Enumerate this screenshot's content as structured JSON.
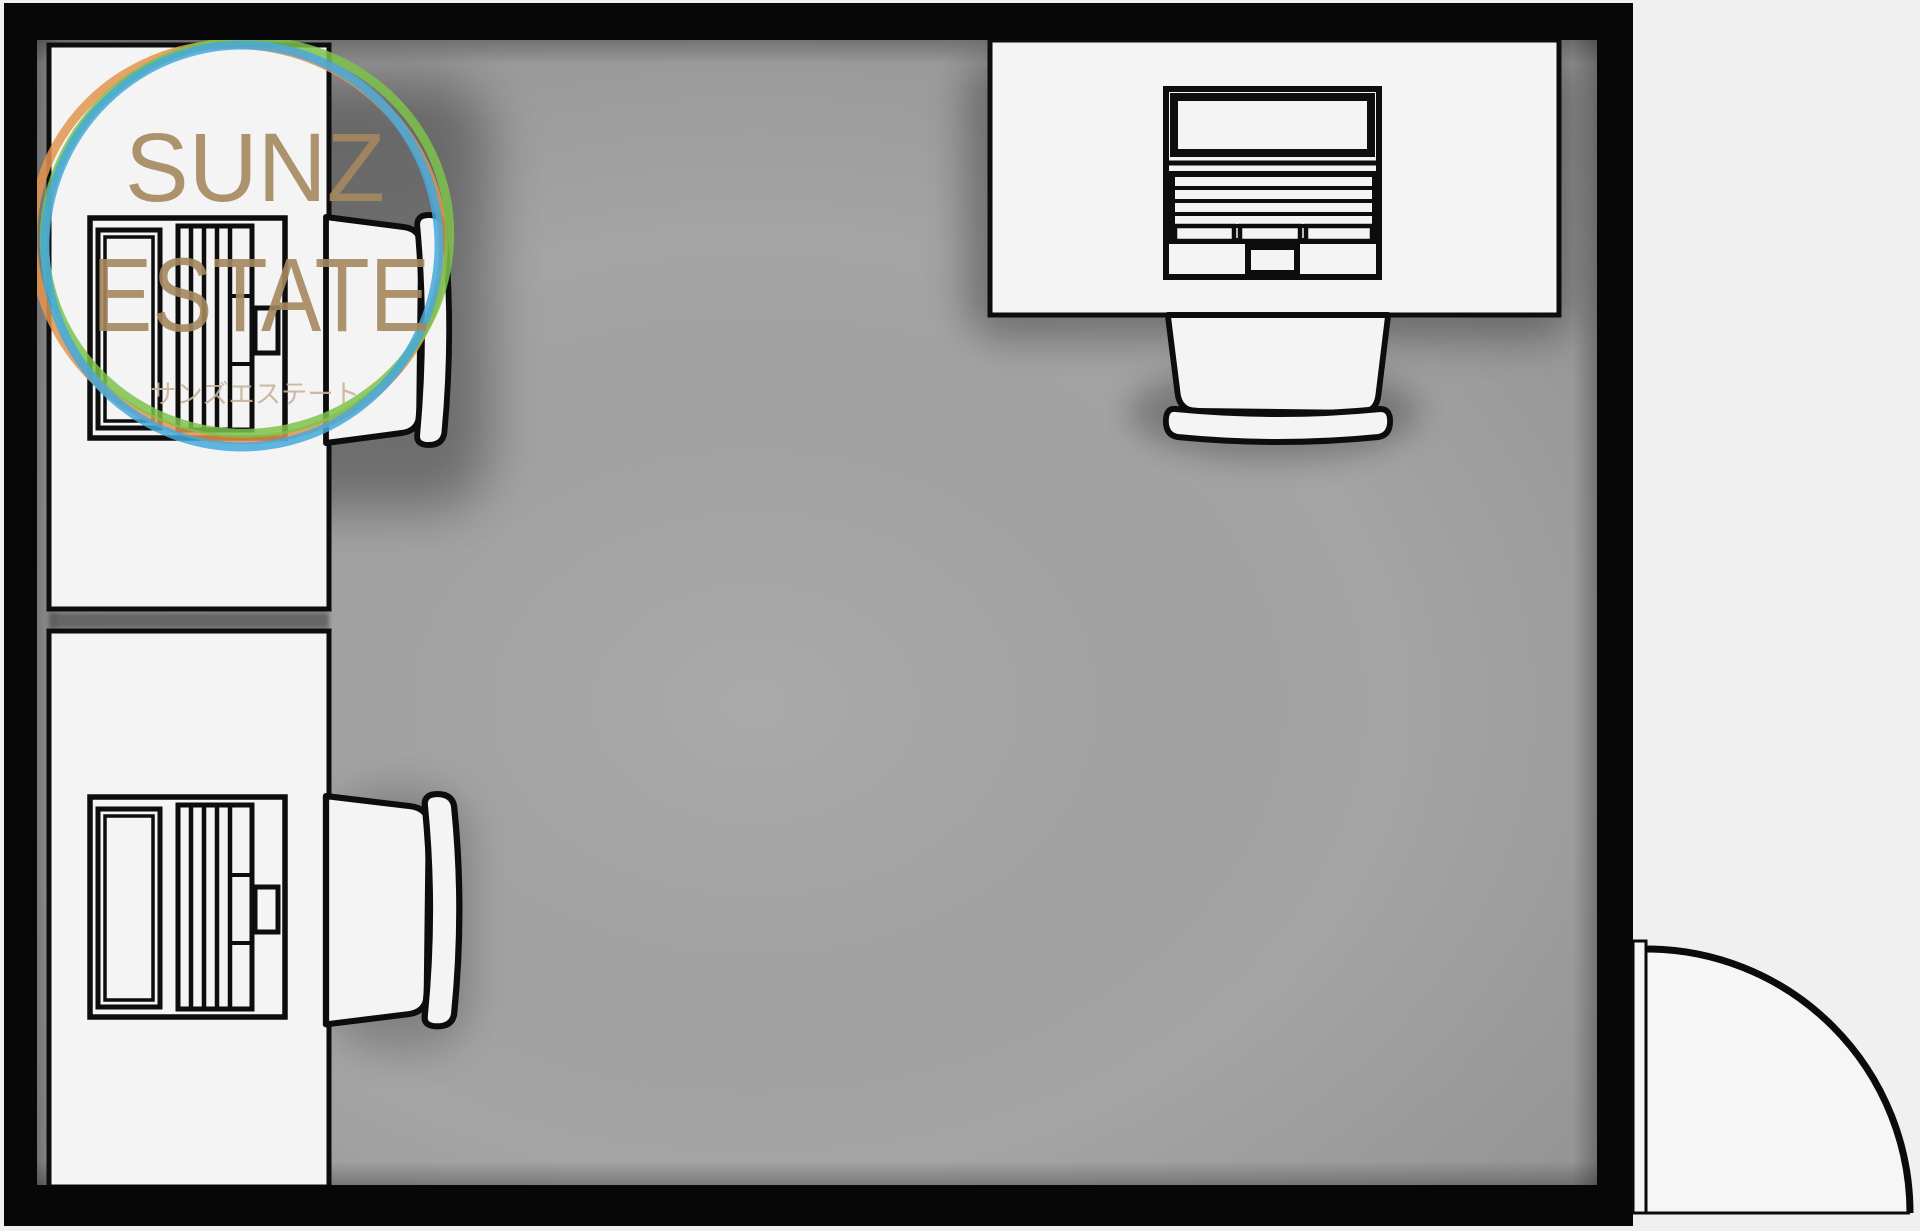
{
  "watermark": {
    "title": "SUNZ",
    "subtitle": "ESTATE",
    "kana": "サンズエステート",
    "title_color": "#a5885f",
    "kana_color": "#c9b29a",
    "rings": {
      "orange": "#e2944e",
      "blue": "#45a9dc",
      "green": "#7dc24b"
    }
  },
  "palette": {
    "wall": "#070707",
    "floor": "#a4a4a4",
    "exterior": "#f0f0f0",
    "furniture_fill": "#f4f4f4",
    "outline": "#0d0d0d",
    "door_fill": "#f6f6f6"
  }
}
